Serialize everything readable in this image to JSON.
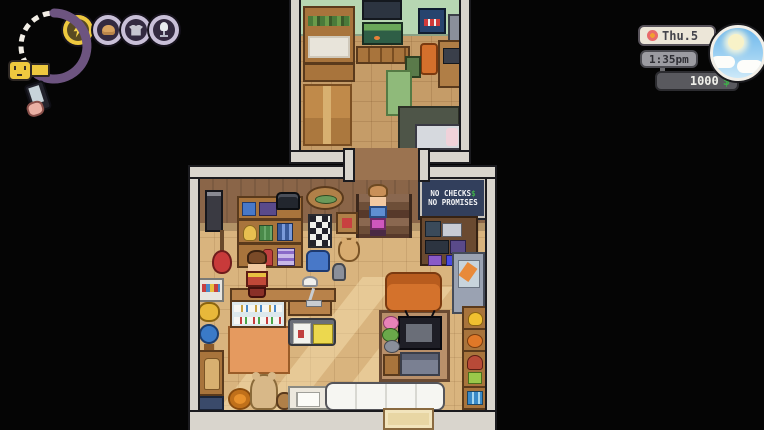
{
  "hud": {
    "stats": {
      "icons": [
        {
          "name": "energy",
          "glyph": "lightning-bolt",
          "active": true
        },
        {
          "name": "food",
          "glyph": "bread"
        },
        {
          "name": "laundry",
          "glyph": "shirt"
        },
        {
          "name": "karaoke",
          "glyph": "microphone"
        }
      ],
      "mood_face": "neutral"
    },
    "phone": {
      "icon": "hand-holding-phone"
    },
    "date": {
      "icon": "flower",
      "label": "Thu.5"
    },
    "time": {
      "label": "1:35pm"
    },
    "money": {
      "amount": "1000",
      "currency": "$"
    },
    "weather": {
      "condition": "sunny-with-clouds"
    }
  },
  "scene": {
    "sign": {
      "line1": "NO CHECKS",
      "dollar": "$",
      "line2": "NO PROMISES"
    },
    "rooms": [
      "upstairs-bedroom",
      "thrift-shop"
    ],
    "characters": [
      "player",
      "shopkeeper"
    ]
  },
  "colors": {
    "money_green": "#3fae4a",
    "hud_accent_yellow": "#eec93f",
    "ring_purple": "#6d5480",
    "sign_navy": "#323f5c",
    "wall_light": "#d9d5cd",
    "shop_wall_brown": "#8a6548",
    "shop_floor": "#d9b47e",
    "upper_wall_mint": "#b7d7b2",
    "upper_floor": "#c59c68",
    "weather_sky": "#6db7ec"
  }
}
